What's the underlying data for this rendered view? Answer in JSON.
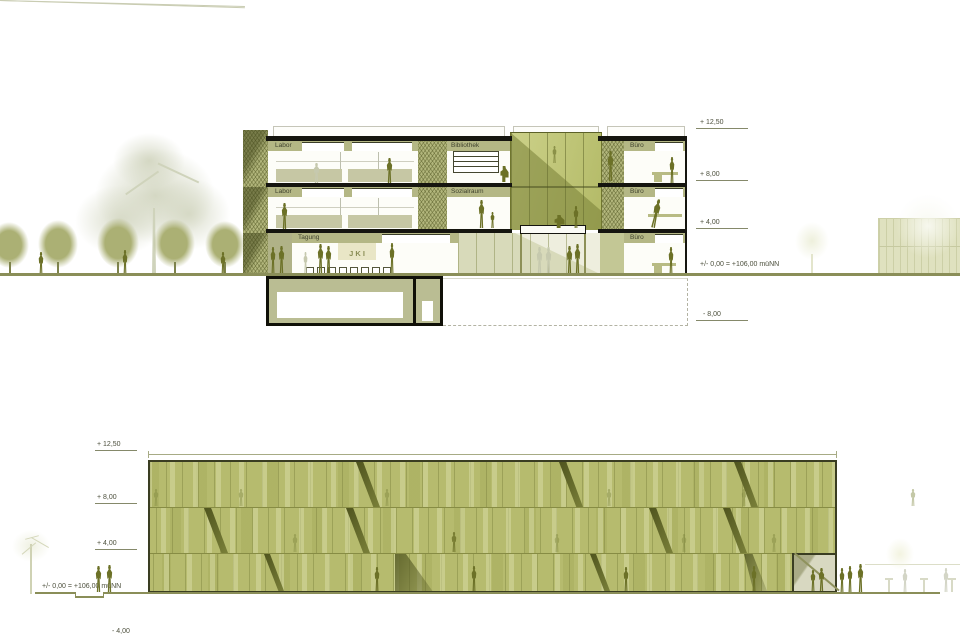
{
  "drawing_type": "architectural section and elevation",
  "colors": {
    "facade_green": "#b6bb6e",
    "facade_light_strip": "#d6daa2",
    "silhouette_olive": "#6c7127",
    "ground_line": "#8a8e58",
    "atrium_green": "#b9c173",
    "sign_background": "#e9e6c6",
    "text": "#4c4f3c"
  },
  "section": {
    "rooms": {
      "labor2": "Labor",
      "labor1": "Labor",
      "bibliothek": "Bibliothek",
      "sozialraum": "Sozialraum",
      "tagung": "Tagung",
      "buero2": "Büro",
      "buero1": "Büro",
      "buero0": "Büro"
    },
    "sign_text": "J K I",
    "levels": [
      {
        "label": "+ 12,50"
      },
      {
        "label": "+ 8,00"
      },
      {
        "label": "+ 4,00"
      },
      {
        "label": "+/- 0,00 = +106,00 müNN"
      },
      {
        "label": "- 8,00"
      }
    ]
  },
  "elevation": {
    "levels": [
      {
        "label": "+ 12,50"
      },
      {
        "label": "+ 8,00"
      },
      {
        "label": "+ 4,00"
      },
      {
        "label": "+/- 0,00 = +106,00 müNN"
      },
      {
        "label": "- 4,00"
      }
    ]
  }
}
